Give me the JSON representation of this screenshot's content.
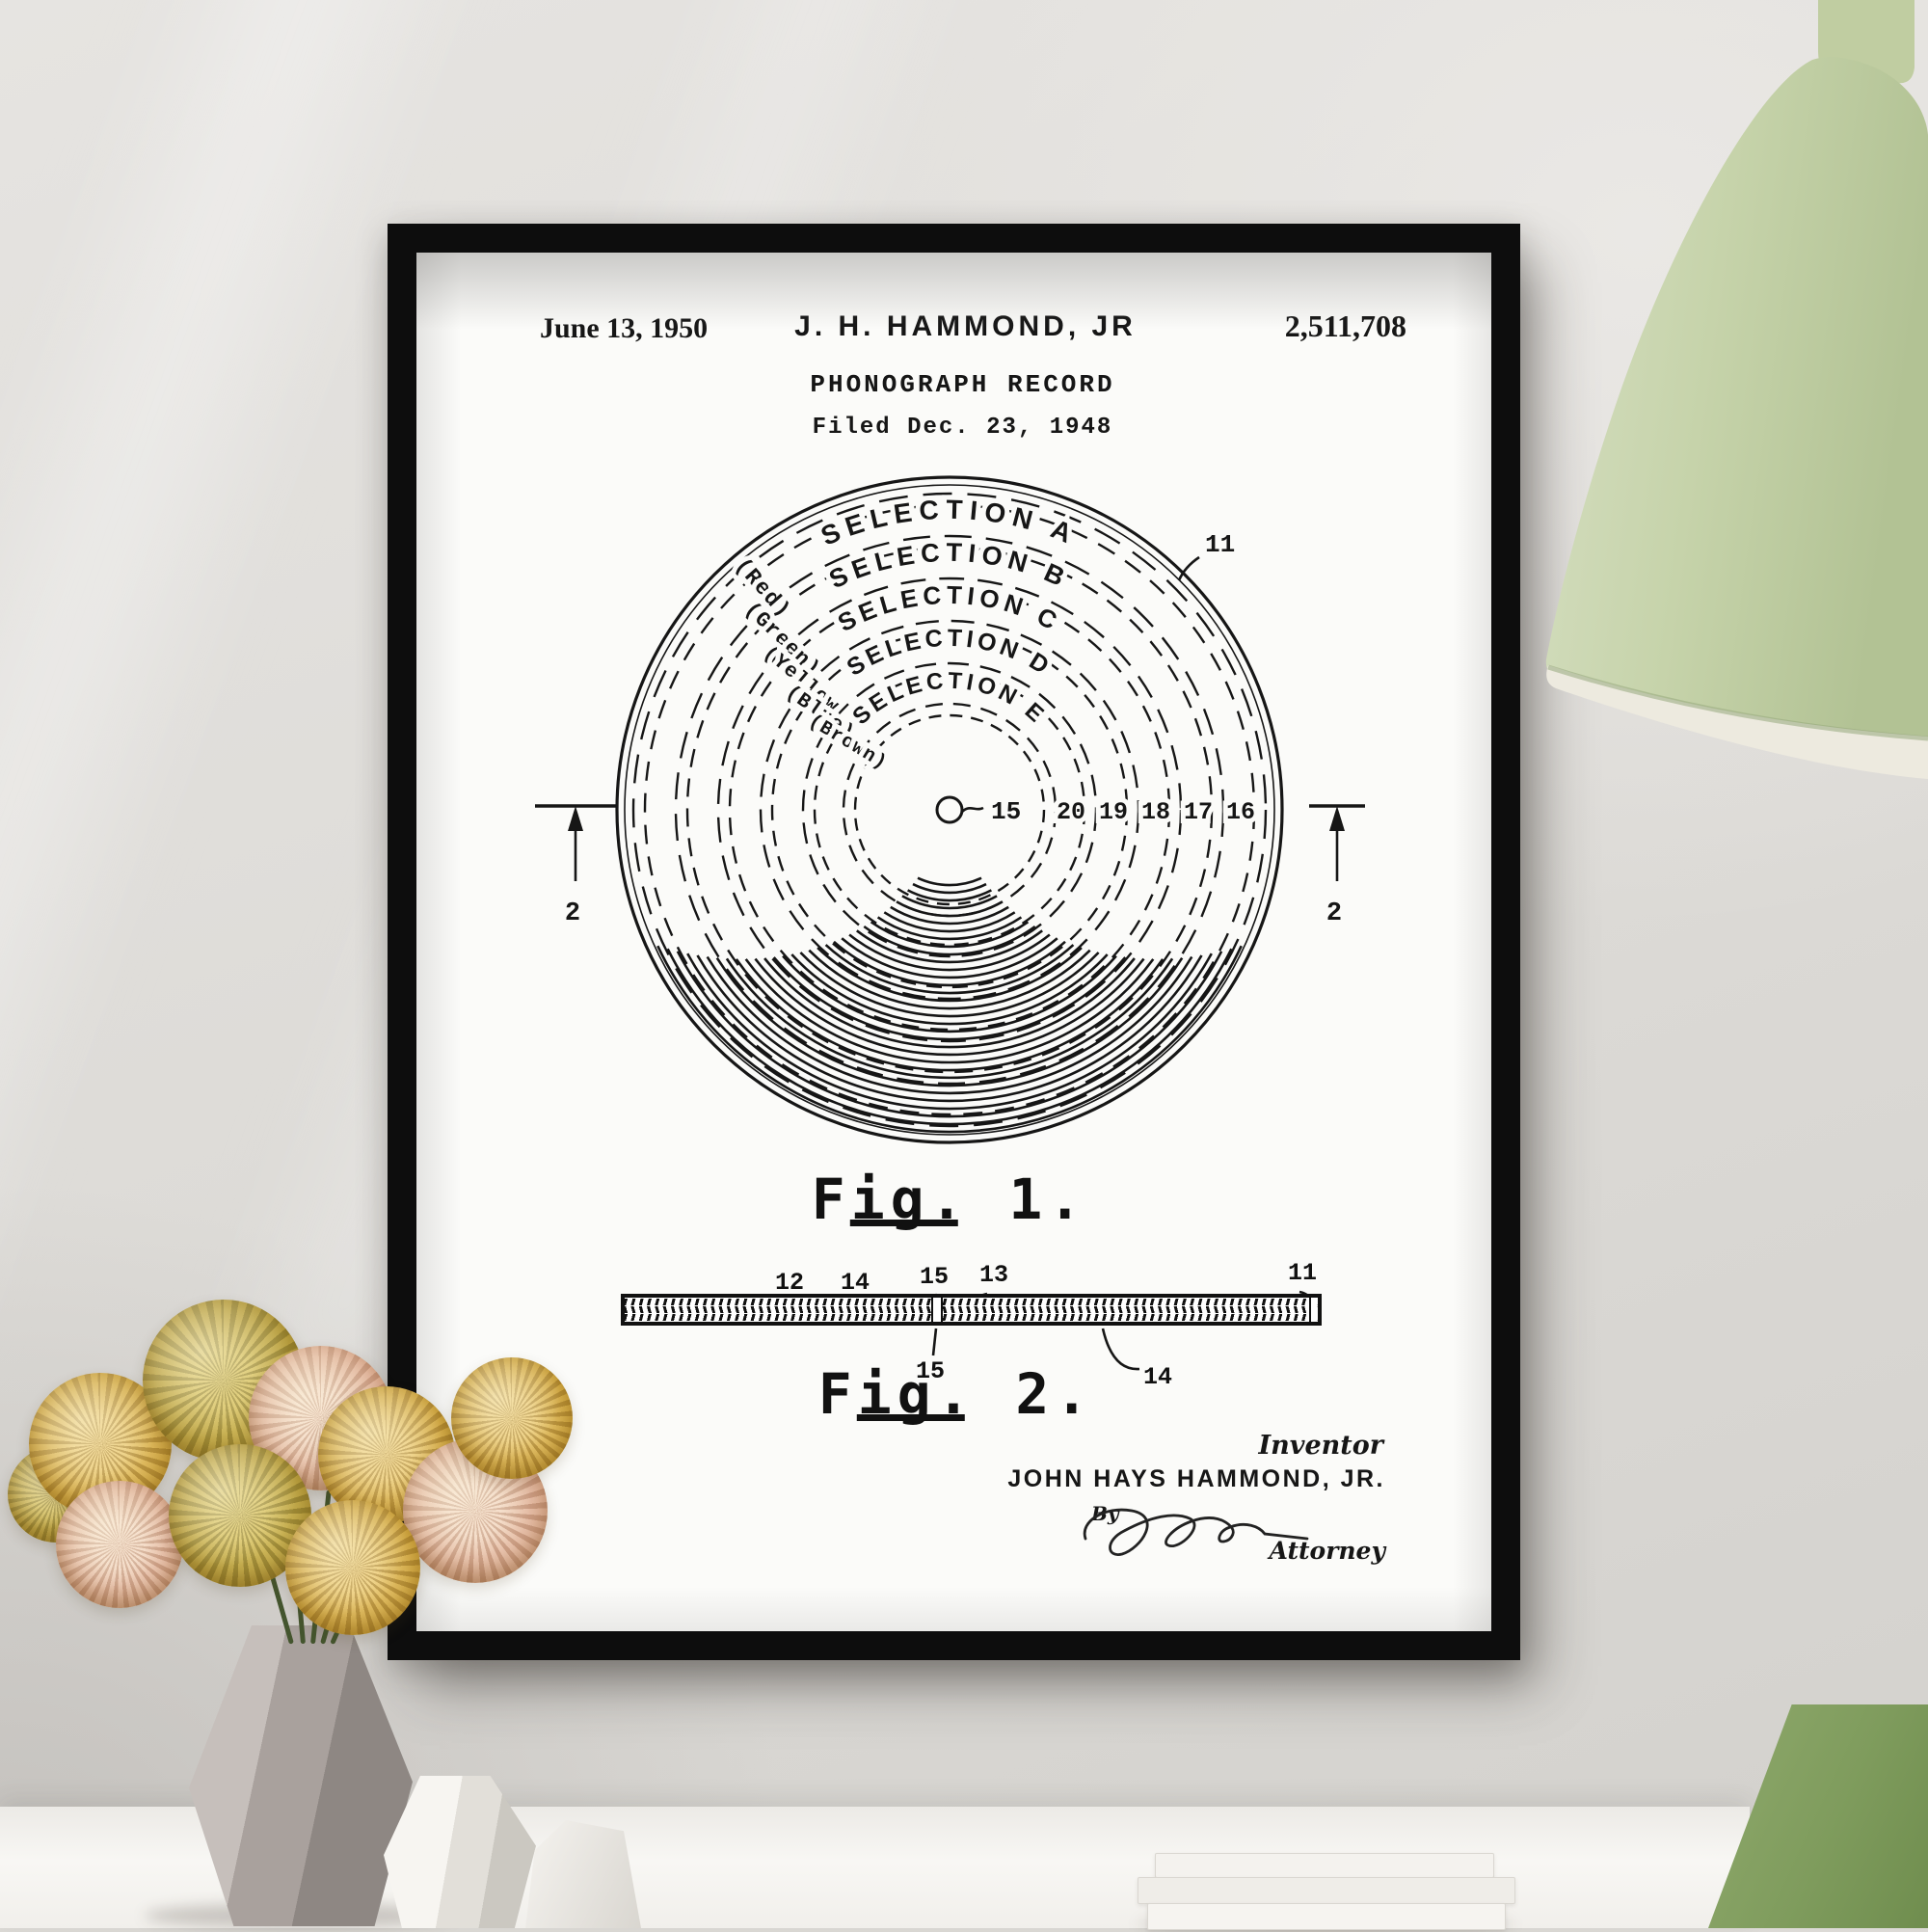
{
  "artwork": {
    "header": {
      "date": "June 13, 1950",
      "inventor": "J. H. HAMMOND, JR",
      "patent_number": "2,511,708",
      "title": "PHONOGRAPH RECORD",
      "filed": "Filed Dec. 23, 1948"
    },
    "fig1": {
      "label": "Fig. 1.",
      "selections": [
        "SELECTION A",
        "SELECTION B",
        "SELECTION C",
        "SELECTION D",
        "SELECTION E"
      ],
      "color_labels": [
        "(Red)",
        "(Green)",
        "(Yellow)",
        "(Blue)",
        "(Brown)"
      ],
      "band_refs": [
        "20",
        "19",
        "18",
        "17",
        "16"
      ],
      "center_ref": "15",
      "edge_ref": "11",
      "section_ref": "2"
    },
    "fig2": {
      "label": "Fig. 2.",
      "top_refs": [
        "12",
        "14",
        "15",
        "13",
        "11"
      ],
      "bottom_refs": [
        "15",
        "14"
      ]
    },
    "signature": {
      "inventor_label": "Inventor",
      "inventor_name": "JOHN HAYS HAMMOND, JR.",
      "by_label": "By",
      "attorney_label": "Attorney"
    }
  },
  "scene": {
    "colors": {
      "wall": "#dcdad6",
      "frame": "#0d0d0d",
      "paper": "#fbfbf9",
      "ink": "#161616",
      "lamp_shade": "#c6d3aa",
      "lamp_inner": "#ebe8df",
      "chair_green": "#7f9c5d",
      "flower_yellow": "#cda33c",
      "flower_pink": "#dcab90",
      "vase_gray": "#a9a19d",
      "vase_white": "#f2f0ec"
    }
  }
}
